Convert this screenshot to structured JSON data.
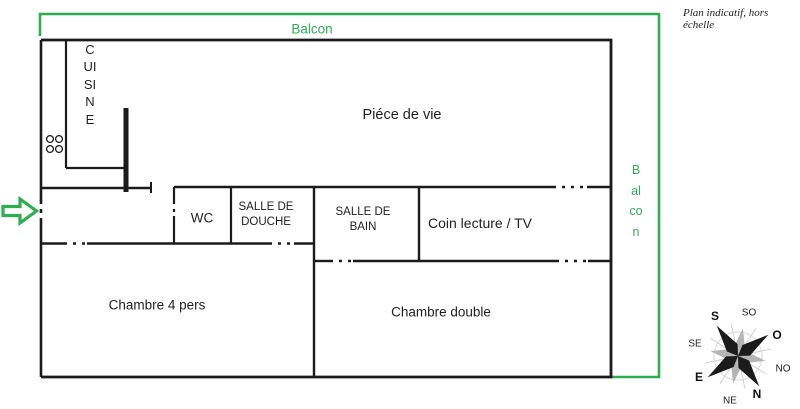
{
  "title_note": "Plan indicatif, hors échelle",
  "colors": {
    "balcony_green": "#2fad53",
    "wall": "#1b1b1b",
    "compass_gray": "#b5b5b5"
  },
  "balcony": {
    "top_label": "Balcon",
    "right_label": "Balcon"
  },
  "rooms": {
    "cuisine": "CUISINE",
    "piece_de_vie": "Piéce de vie",
    "wc": "WC",
    "salle_de_douche": "SALLE DE DOUCHE",
    "salle_de_bain": "SALLE DE BAIN",
    "coin_lecture_tv": "Coin lecture / TV",
    "chambre_4_pers": "Chambre 4 pers",
    "chambre_double": "Chambre double"
  },
  "compass": {
    "s": "S",
    "so": "SO",
    "o": "O",
    "no": "NO",
    "n": "N",
    "ne": "NE",
    "e": "E",
    "se": "SE"
  }
}
